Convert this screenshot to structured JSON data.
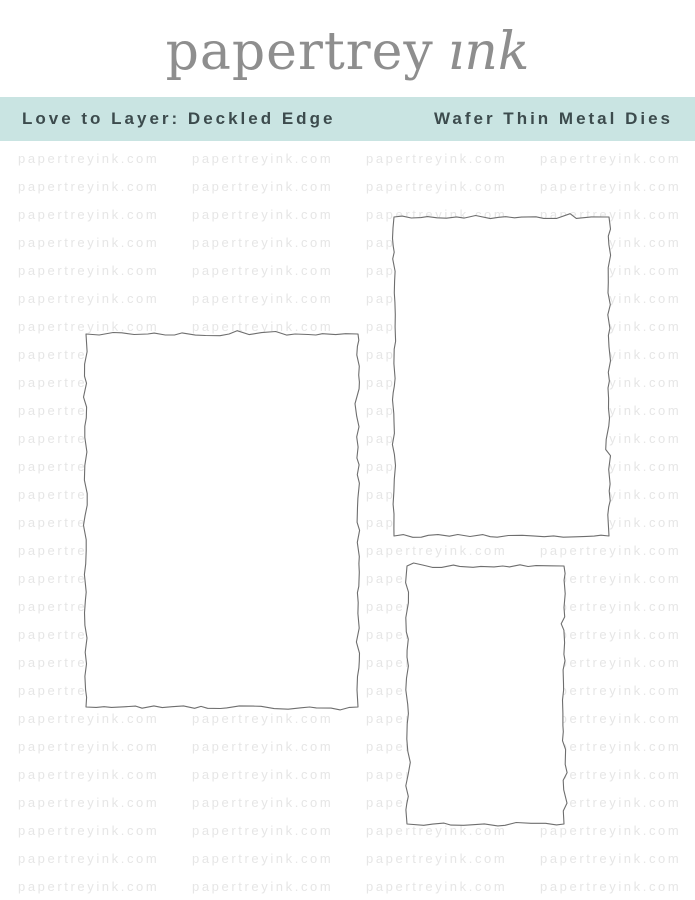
{
  "brand": {
    "name_part1": "papertrey",
    "name_part2": "ink",
    "text_color": "#8e8e8e",
    "flower_color": "#5ec5c1"
  },
  "banner": {
    "product_title": "Love to Layer: Deckled Edge",
    "product_type": "Wafer Thin Metal Dies",
    "background_color": "#c9e4e2",
    "text_color": "#3c4b4d"
  },
  "watermark": {
    "text": "papertreyink.com",
    "color": "#e6e6e6",
    "rows": 27,
    "columns": 4,
    "row_spacing_px": 28,
    "column_spacing_px": 174,
    "start_x_px": 18,
    "start_y_px": 11
  },
  "dies": {
    "outline_color": "#6e6e6e",
    "fill_color": "#ffffff",
    "shapes": [
      {
        "name": "deckled-rectangle-die-large",
        "x": 82,
        "y": 189,
        "width": 280,
        "height": 381
      },
      {
        "name": "deckled-rectangle-die-medium",
        "x": 390,
        "y": 72,
        "width": 223,
        "height": 327
      },
      {
        "name": "deckled-rectangle-die-small",
        "x": 403,
        "y": 421,
        "width": 165,
        "height": 266
      }
    ]
  }
}
